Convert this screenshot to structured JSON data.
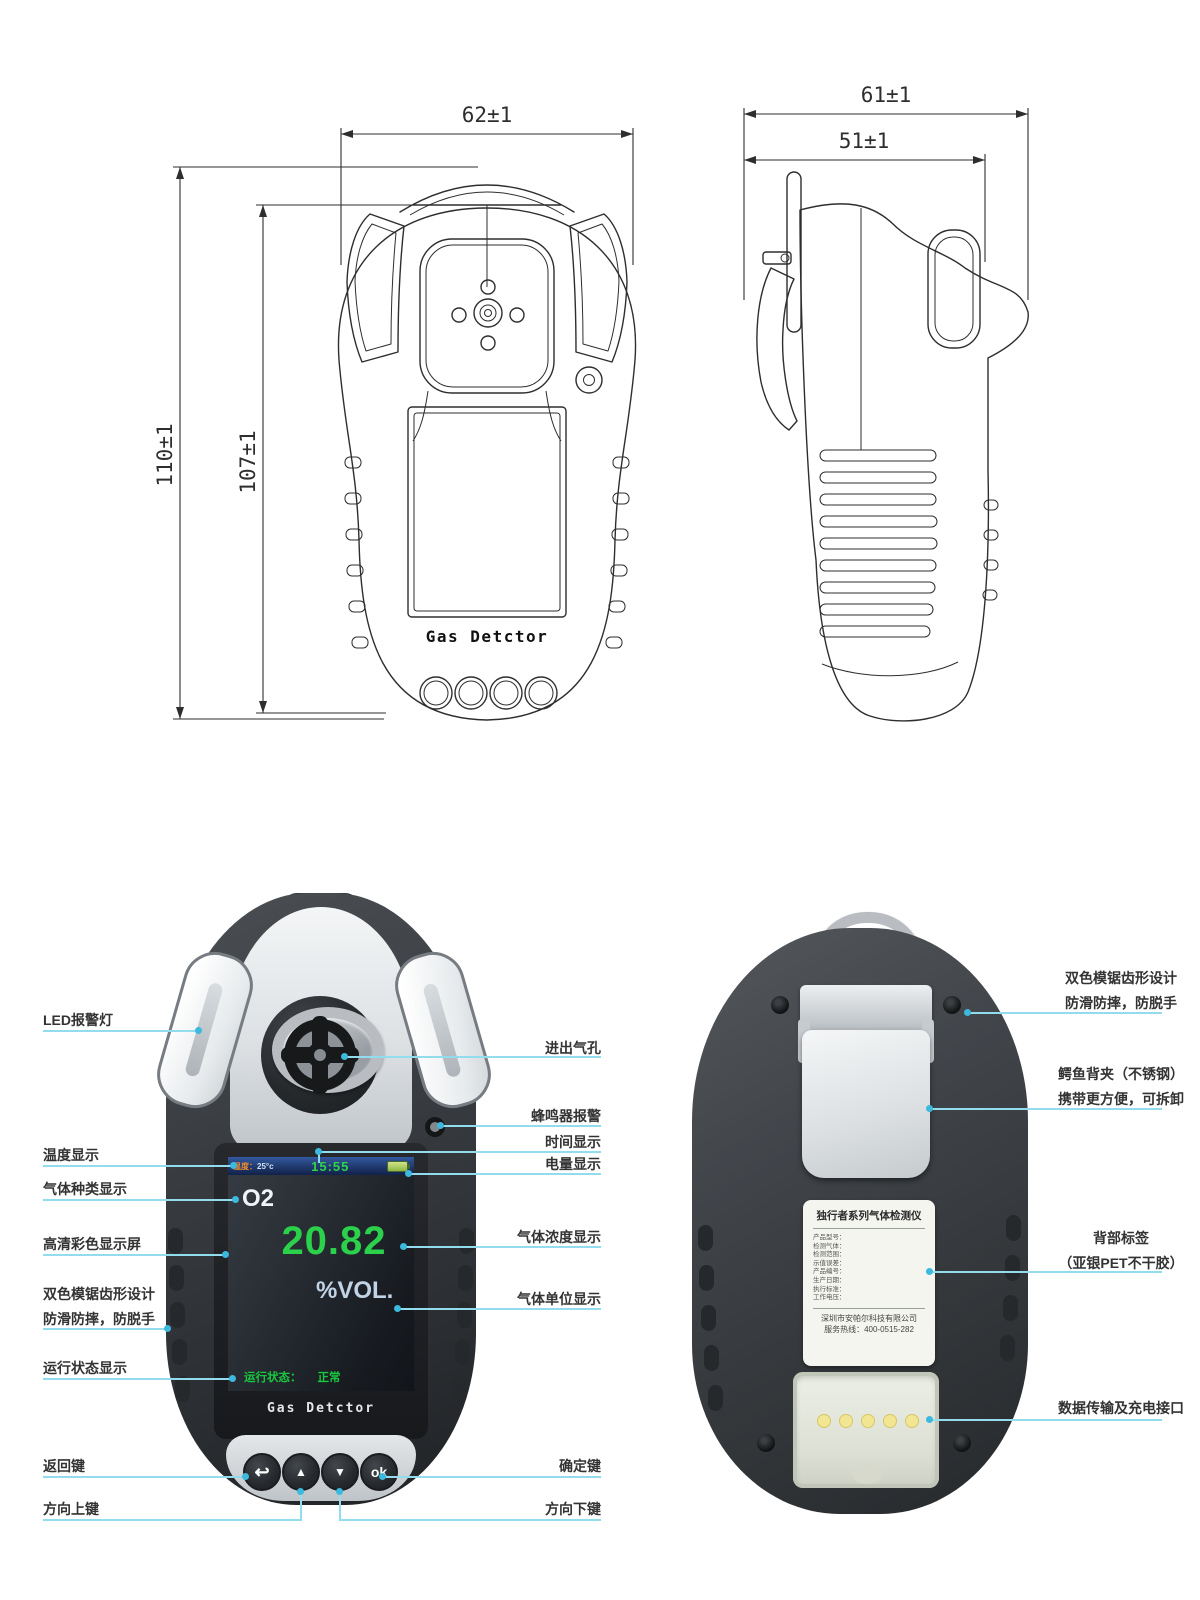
{
  "tech": {
    "front": {
      "dim_top": "62±1",
      "dim_left_outer": "110±1",
      "dim_left_inner": "107±1",
      "brand": "Gas Detctor"
    },
    "side": {
      "dim_top": "61±1",
      "dim_inner": "51±1"
    }
  },
  "front": {
    "brand": "Gas Detctor",
    "screen": {
      "temp_label": "温度：",
      "temp_value": "25°c",
      "time": "15:55",
      "gas": "O2",
      "value": "20.82",
      "unit": "%VOL.",
      "status_label": "运行状态：",
      "status_value": "正常"
    },
    "keys": {
      "back": "↩",
      "up": "▲",
      "down": "▼",
      "ok": "ok"
    },
    "callouts_left": [
      {
        "l1": "LED报警灯"
      },
      {
        "l1": "温度显示"
      },
      {
        "l1": "气体种类显示"
      },
      {
        "l1": "高清彩色显示屏"
      },
      {
        "l1": "双色模锯齿形设计",
        "l2": "防滑防摔，防脱手"
      },
      {
        "l1": "运行状态显示"
      },
      {
        "l1": "返回键"
      },
      {
        "l1": "方向上键"
      }
    ],
    "callouts_right": [
      {
        "l1": "进出气孔"
      },
      {
        "l1": "蜂鸣器报警"
      },
      {
        "l1": "时间显示"
      },
      {
        "l1": "电量显示"
      },
      {
        "l1": "气体浓度显示"
      },
      {
        "l1": "气体单位显示"
      },
      {
        "l1": "确定键"
      },
      {
        "l1": "方向下键"
      }
    ]
  },
  "back": {
    "callouts": [
      {
        "l1": "双色模锯齿形设计",
        "l2": "防滑防摔，防脱手"
      },
      {
        "l1": "鳄鱼背夹（不锈钢）",
        "l2": "携带更方便，可拆卸"
      },
      {
        "l1": "背部标签",
        "l2": "（亚银PET不干胶）"
      },
      {
        "l1": "数据传输及充电接口"
      }
    ],
    "sticker": {
      "title": "独行者系列气体检测仪",
      "fields": [
        "产品型号：",
        "检测气体：",
        "检测范围：",
        "示值误差：",
        "产品编号：",
        "生产日期：",
        "执行标准：",
        "工作电压："
      ],
      "company": "深圳市安帕尔科技有限公司",
      "hotline": "服务热线：400-0515-282"
    }
  }
}
